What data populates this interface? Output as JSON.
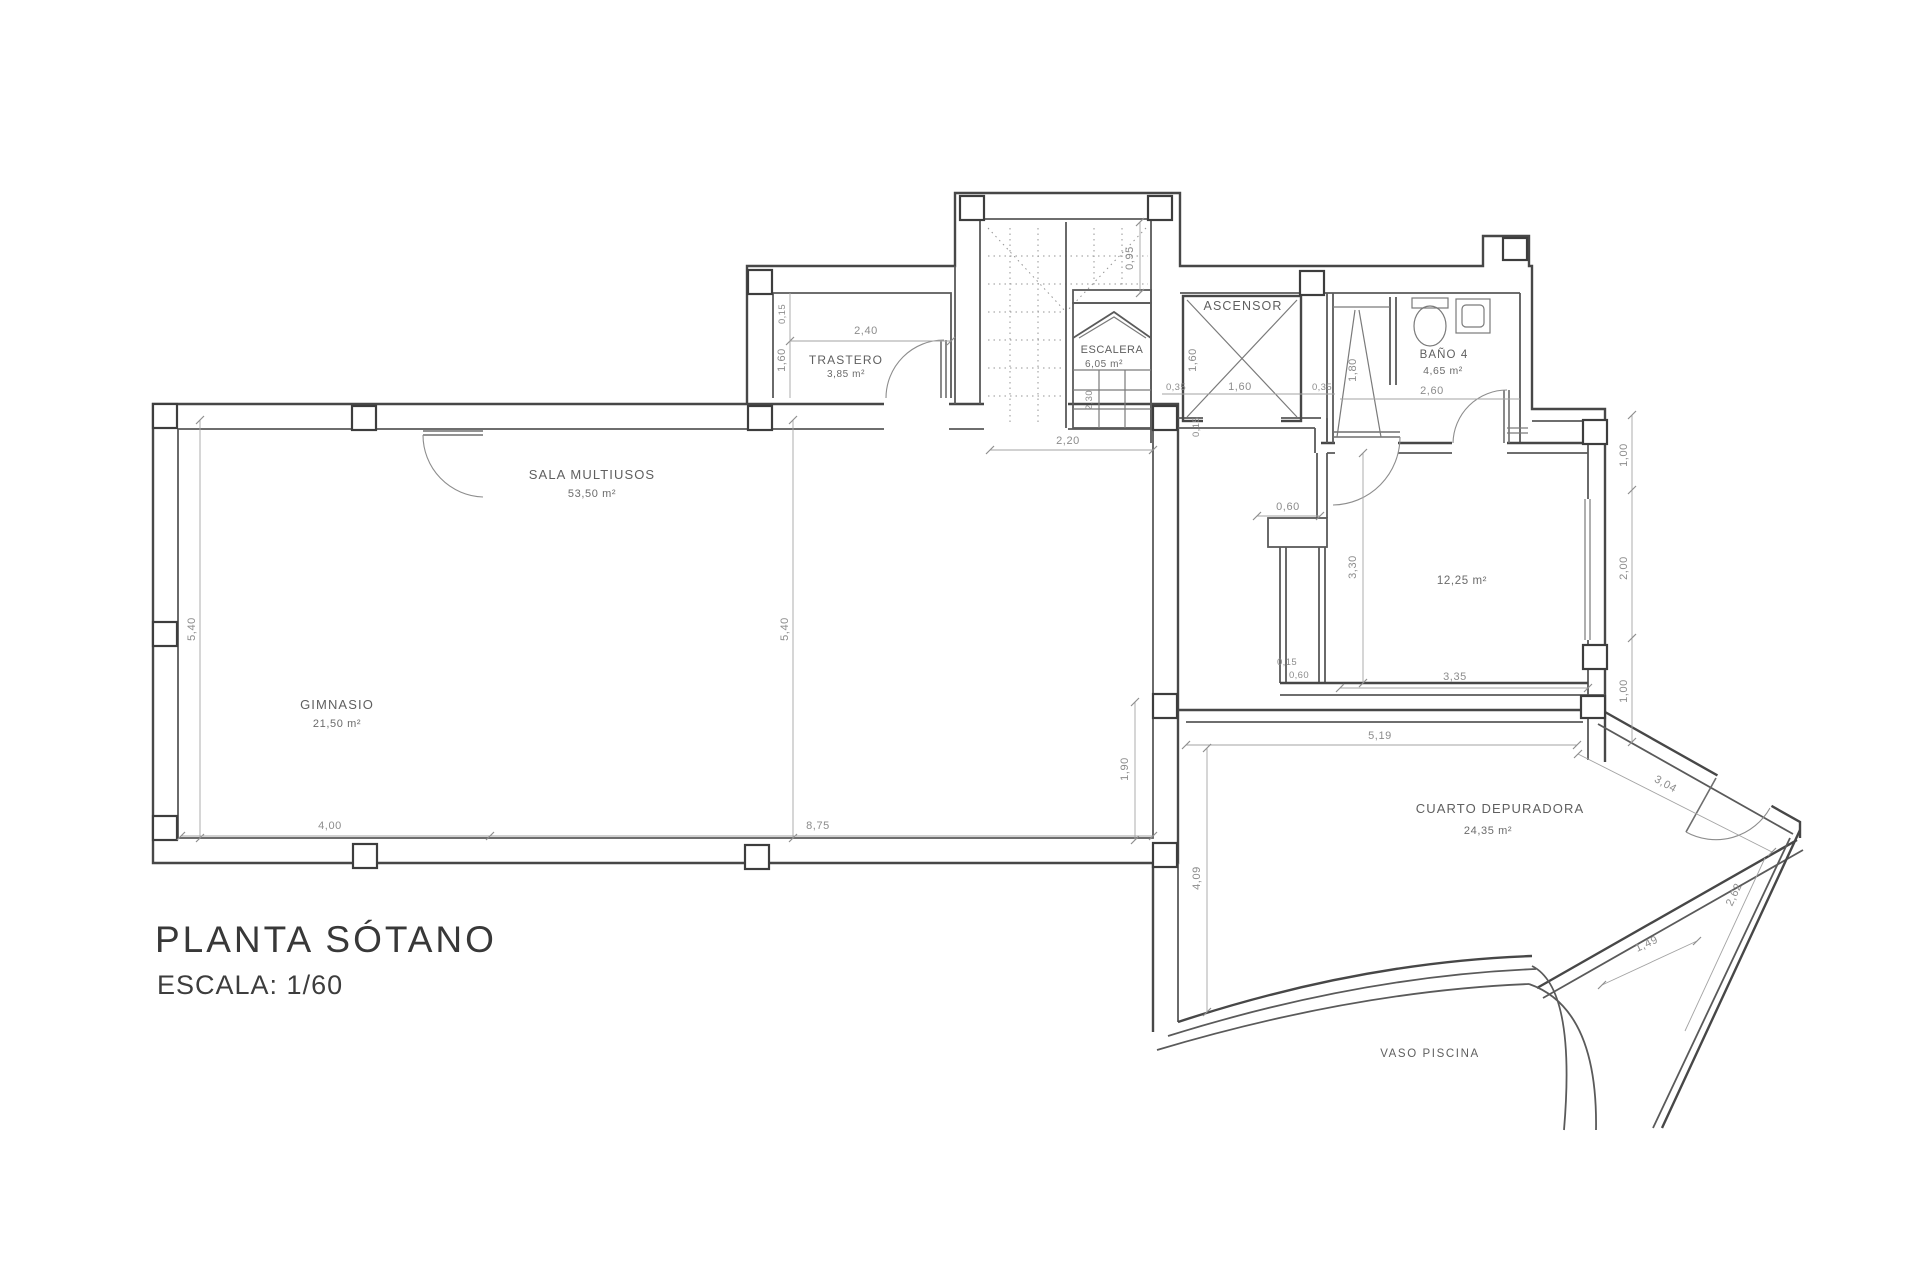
{
  "title": {
    "main": "PLANTA SÓTANO",
    "scale": "ESCALA: 1/60"
  },
  "rooms": {
    "gimnasio": {
      "name": "GIMNASIO",
      "area": "21,50 m²"
    },
    "sala": {
      "name": "SALA MULTIUSOS",
      "area": "53,50 m²"
    },
    "trastero": {
      "name": "TRASTERO",
      "area": "3,85 m²"
    },
    "escalera": {
      "name": "ESCALERA",
      "area": "6,05 m²"
    },
    "ascensor": {
      "name": "ASCENSOR"
    },
    "bano": {
      "name": "BAÑO 4",
      "area": "4,65 m²"
    },
    "sala12": {
      "area": "12,25 m²"
    },
    "depuradora": {
      "name": "CUARTO DEPURADORA",
      "area": "24,35 m²"
    },
    "piscina": {
      "name": "VASO PISCINA"
    }
  },
  "dims": {
    "gim_h": "5,40",
    "sala_h": "5,40",
    "gim_w": "4,00",
    "sala_w": "8,75",
    "tras_w": "2,40",
    "tras_wall": "0,15",
    "tras_h": "1,60",
    "stair_top": "0,95",
    "stair_w": "2,20",
    "stair_run": "2,30",
    "asc_l": "0,35",
    "asc_w": "1,60",
    "asc_r": "0,35",
    "asc_h": "1,60",
    "asc_s": "0,15",
    "shower": "1,80",
    "bano_w": "2,60",
    "niche": "0,60",
    "r12_h": "3,30",
    "r12_w": "3,35",
    "shaft_a": "0,15",
    "shaft_b": "0,60",
    "e1": "1,00",
    "e2": "2,00",
    "e3": "1,00",
    "dep_w": "5,19",
    "gap": "1,90",
    "dep_h": "4,09",
    "dep_d1": "3,04",
    "dep_d2": "2,62",
    "dep_door": "1,49"
  },
  "colors": {
    "wall": "#474747",
    "thin_line": "#a3a3a3",
    "dim_text": "#8c8c8c",
    "room_text": "#5f5f5f",
    "title_text": "#383838",
    "background": "#ffffff"
  }
}
